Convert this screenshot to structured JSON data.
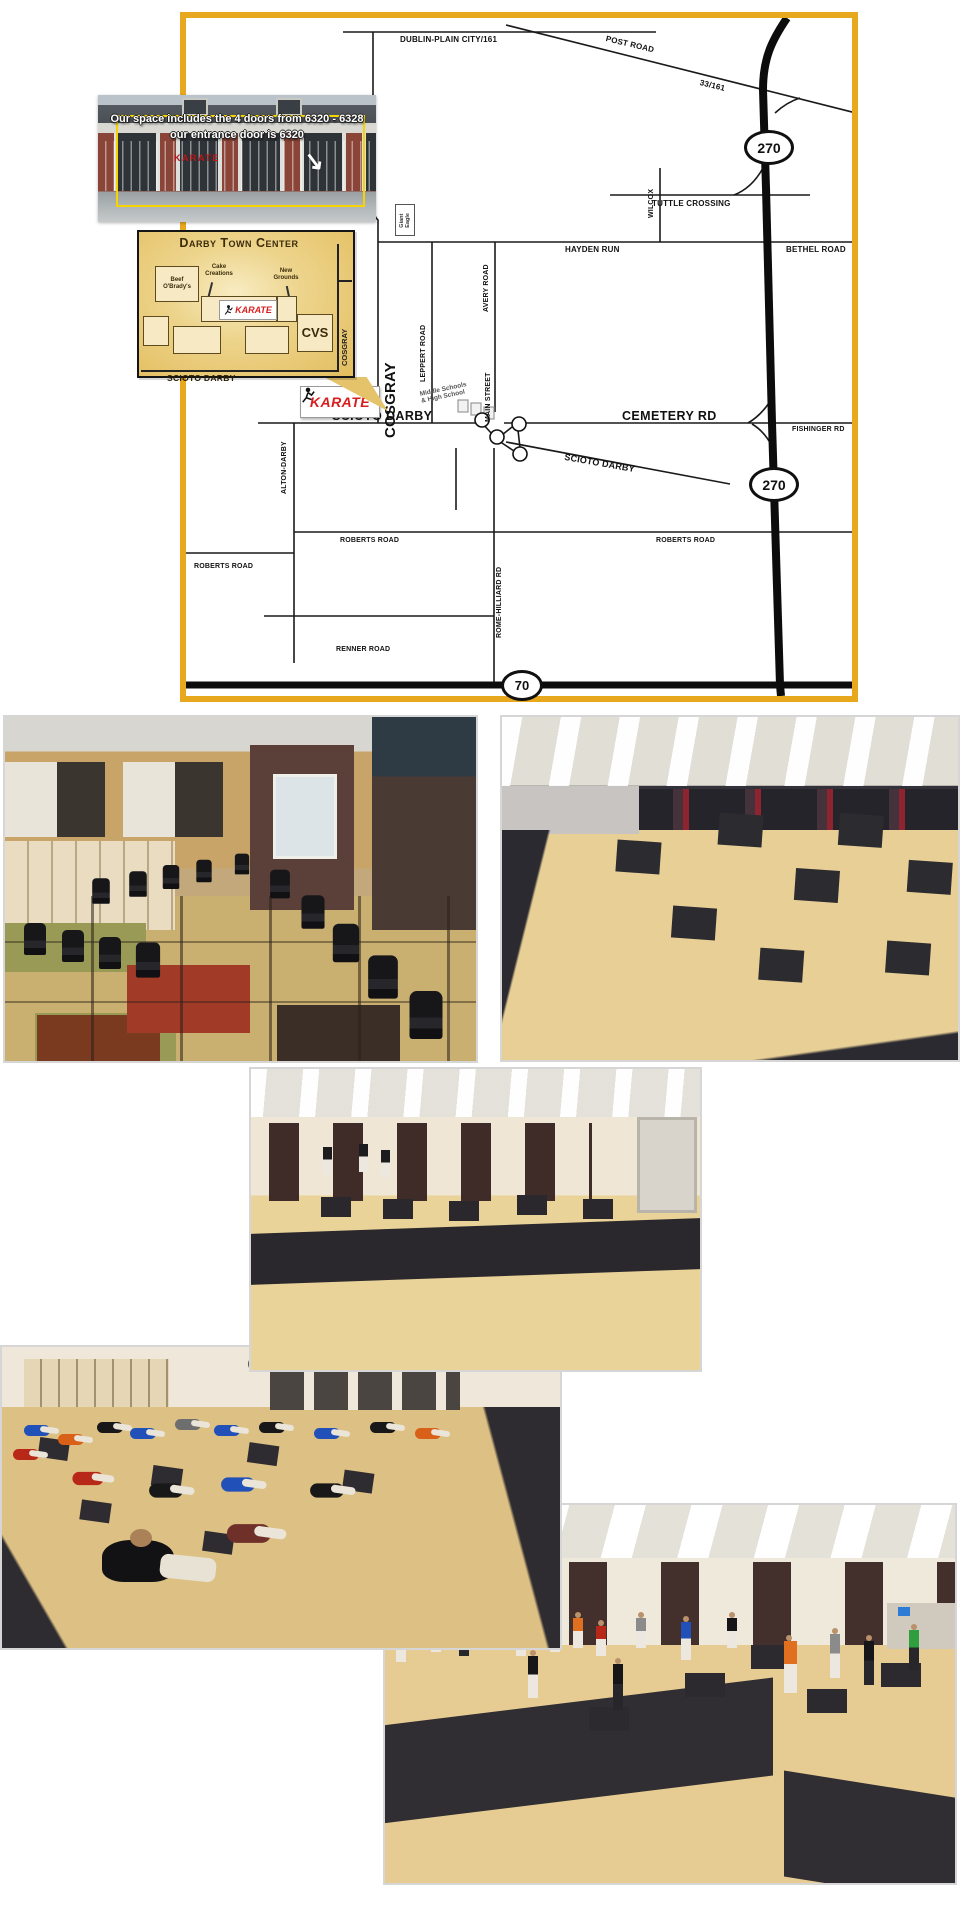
{
  "map": {
    "labels": {
      "dublin": "DUBLIN-PLAIN CITY/161",
      "post": "POST ROAD",
      "route33": "33/161",
      "cosgray_top": "COSGRAY",
      "cosgray_big": "COSGRAY",
      "wilcox": "WILCOX",
      "tuttle": "TUTTLE CROSSING",
      "hayden": "HAYDEN RUN",
      "bethel": "BETHEL ROAD",
      "avery": "AVERY ROAD",
      "leppert": "LEPPERT ROAD",
      "main_street": "MAIN STREET",
      "school": "Middle Schools\n& High School",
      "giant_eagle": "Giant\nEagle",
      "scioto_west": "SCIOTO DARBY",
      "cemetery": "CEMETERY RD",
      "fishinger": "FISHINGER RD",
      "scioto_diag": "SCIOTO DARBY",
      "alton": "ALTON-DARBY",
      "roberts_left": "ROBERTS ROAD",
      "roberts_mid": "ROBERTS ROAD",
      "roberts_right": "ROBERTS ROAD",
      "renner": "RENNER ROAD",
      "rome_hilliard": "ROME-HILLIARD RD"
    },
    "shields": {
      "i270": "270",
      "i70": "70"
    },
    "karate_marker": {
      "label": "KARATE"
    }
  },
  "storefront": {
    "caption_line1": "Our space includes the 4 doors from 6320 - 6328",
    "caption_line2": "our entrance door is 6320",
    "sign": "KARATE"
  },
  "darby": {
    "title": "Darby Town Center",
    "beef": "Beef\nO'Brady's",
    "cake": "Cake\nCreations",
    "new_grounds": "New\nGrounds",
    "karate": "KARATE",
    "cvs": "CVS",
    "cosgray": "COSGRAY",
    "scioto": "SCIOTO DARBY"
  },
  "photos": {
    "lobby": {
      "alt": "Lobby waiting area with rows of black chairs and cubbies"
    },
    "training_floor": {
      "alt": "Large training floor with tan puzzle mats and black squares"
    },
    "studio": {
      "alt": "Training room with tan mat floor, black mat band and doorways"
    },
    "stretching": {
      "alt": "Students seated stretching on the mat floor"
    },
    "class_standing": {
      "alt": "Students standing in rows during class"
    }
  },
  "colors": {
    "map_border": "#E8A81E",
    "karate_red": "#D81F1F",
    "inset_gold": "#E9C768",
    "mat_tan": "#E2C98F",
    "mat_black": "#2B2A30"
  }
}
